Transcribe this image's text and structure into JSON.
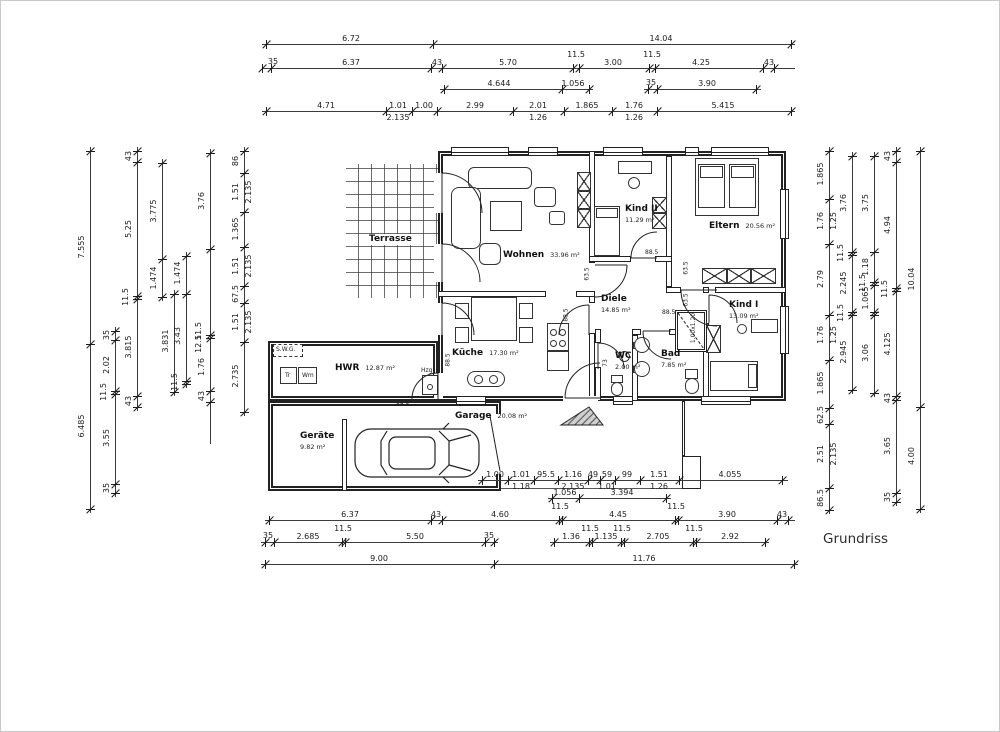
{
  "title": {
    "text": "Grundriss"
  },
  "colors": {
    "line": "#2a2a2a",
    "dim_text": "#1b1b1b",
    "bg": "#ffffff",
    "hatch": "#4a4a4a"
  },
  "rooms": [
    {
      "id": "terrasse",
      "name": "Terrasse",
      "area": ""
    },
    {
      "id": "wohnen",
      "name": "Wohnen",
      "area": "33.96 m²"
    },
    {
      "id": "kind2",
      "name": "Kind II",
      "area": "11.29 m²"
    },
    {
      "id": "eltern",
      "name": "Eltern",
      "area": "20.56 m²"
    },
    {
      "id": "diele",
      "name": "Diele",
      "area": "14.85 m²"
    },
    {
      "id": "kueche",
      "name": "Küche",
      "area": "17.30 m²"
    },
    {
      "id": "wc",
      "name": "WC",
      "area": "2.00 m²"
    },
    {
      "id": "bad",
      "name": "Bad",
      "area": "7.85 m²"
    },
    {
      "id": "kind1",
      "name": "Kind I",
      "area": "13.09 m²"
    },
    {
      "id": "hwr",
      "name": "HWR",
      "area": "12.87 m²"
    },
    {
      "id": "garage",
      "name": "Garage",
      "area": "20.08 m²"
    },
    {
      "id": "geraete",
      "name": "Geräte",
      "area": "9.82 m²"
    }
  ],
  "fixtures": {
    "swg": "S.W.G.",
    "tr": "Tr",
    "wm": "Wm",
    "hzg": "Hzg",
    "shower_size": "1.00x1.20"
  },
  "door_dimensions": [
    {
      "t": "88.5",
      "x": 644,
      "y": 249,
      "v": 0
    },
    {
      "t": "63.5",
      "x": 580,
      "y": 270,
      "v": 1
    },
    {
      "t": "63.5",
      "x": 679,
      "y": 264,
      "v": 1
    },
    {
      "t": "63.5",
      "x": 679,
      "y": 296,
      "v": 1
    },
    {
      "t": "73",
      "x": 601,
      "y": 359,
      "v": 1
    },
    {
      "t": "88.5",
      "x": 661,
      "y": 309,
      "v": 0
    },
    {
      "t": "88.5",
      "x": 395,
      "y": 401,
      "v": 0
    },
    {
      "t": "88.5",
      "x": 441,
      "y": 356,
      "v": 1
    },
    {
      "t": "88.5",
      "x": 559,
      "y": 311,
      "v": 1
    }
  ],
  "dim_chains": [
    {
      "o": "h",
      "p": 43,
      "a": 261,
      "b": 794,
      "ticks": [
        265,
        432,
        790
      ],
      "labels": [
        {
          "t": "6.72",
          "c": 350
        },
        {
          "t": "14.04",
          "c": 660
        }
      ]
    },
    {
      "o": "h",
      "p": 67,
      "a": 261,
      "b": 794,
      "ticks": [
        261,
        270,
        430,
        441,
        572,
        578,
        648,
        654,
        762,
        773
      ],
      "labels": [
        {
          "t": "35",
          "c": 272,
          "dy": -1
        },
        {
          "t": "6.37",
          "c": 350
        },
        {
          "t": "43",
          "c": 436
        },
        {
          "t": "5.70",
          "c": 507
        },
        {
          "t": "11.5",
          "c": 575,
          "dy": -8
        },
        {
          "t": "3.00",
          "c": 612
        },
        {
          "t": "11.5",
          "c": 651,
          "dy": -8
        },
        {
          "t": "4.25",
          "c": 700
        },
        {
          "t": "43",
          "c": 768
        }
      ]
    },
    {
      "o": "h",
      "p": 88,
      "a": 439,
      "b": 592,
      "ticks": [
        443,
        561,
        588
      ],
      "labels": [
        {
          "t": "4.644",
          "c": 498
        },
        {
          "t": "1.056",
          "c": 572
        }
      ]
    },
    {
      "o": "h",
      "p": 88,
      "a": 643,
      "b": 760,
      "ticks": [
        647,
        656,
        755
      ],
      "labels": [
        {
          "t": "35",
          "c": 650,
          "dy": -1
        },
        {
          "t": "3.90",
          "c": 706
        }
      ]
    },
    {
      "o": "h",
      "p": 110,
      "a": 261,
      "b": 794,
      "ticks": [
        265,
        385,
        411,
        436,
        512,
        563,
        611,
        656,
        790
      ],
      "labels": [
        {
          "t": "4.71",
          "c": 325
        },
        {
          "t": "1.01",
          "c": 397,
          "t2": "2.135"
        },
        {
          "t": "1.00",
          "c": 423
        },
        {
          "t": "2.99",
          "c": 474
        },
        {
          "t": "2.01",
          "c": 537,
          "t2": "1.26"
        },
        {
          "t": "1.865",
          "c": 586
        },
        {
          "t": "1.76",
          "c": 633,
          "t2": "1.26"
        },
        {
          "t": "5.415",
          "c": 722
        }
      ]
    },
    {
      "o": "h",
      "p": 479,
      "a": 477,
      "b": 787,
      "ticks": [
        481,
        507,
        533,
        557,
        587,
        599,
        614,
        639,
        678,
        781
      ],
      "labels": [
        {
          "t": "1.00",
          "c": 494
        },
        {
          "t": "1.01",
          "c": 520,
          "t2": "1.18"
        },
        {
          "t": "95.5",
          "c": 545
        },
        {
          "t": "1.16",
          "c": 572,
          "t2": "2.135"
        },
        {
          "t": "49",
          "c": 592
        },
        {
          "t": "59",
          "c": 606,
          "t2": "1.01"
        },
        {
          "t": "99",
          "c": 626
        },
        {
          "t": "1.51",
          "c": 658,
          "t2": "1.26"
        },
        {
          "t": "4.055",
          "c": 729
        }
      ]
    },
    {
      "o": "h",
      "p": 497,
      "a": 547,
      "b": 670,
      "ticks": [
        551,
        578,
        665
      ],
      "labels": [
        {
          "t": "1.056",
          "c": 564
        },
        {
          "t": "3.394",
          "c": 621
        }
      ]
    },
    {
      "o": "h",
      "p": 519,
      "a": 264,
      "b": 794,
      "ticks": [
        268,
        430,
        441,
        558,
        561,
        674,
        677,
        776,
        787
      ],
      "labels": [
        {
          "t": "6.37",
          "c": 349
        },
        {
          "t": "43",
          "c": 435
        },
        {
          "t": "4.60",
          "c": 499
        },
        {
          "t": "11.5",
          "c": 559,
          "dy": -8
        },
        {
          "t": "4.45",
          "c": 617
        },
        {
          "t": "11.5",
          "c": 675,
          "dy": -8
        },
        {
          "t": "3.90",
          "c": 726
        },
        {
          "t": "43",
          "c": 781
        }
      ]
    },
    {
      "o": "h",
      "p": 541,
      "a": 260,
      "b": 497,
      "ticks": [
        264,
        273,
        341,
        344,
        484,
        493
      ],
      "labels": [
        {
          "t": "35",
          "c": 267,
          "dy": -1
        },
        {
          "t": "2.685",
          "c": 307
        },
        {
          "t": "11.5",
          "c": 342,
          "dy": -8
        },
        {
          "t": "5.50",
          "c": 414
        },
        {
          "t": "35",
          "c": 488,
          "dy": -1
        }
      ]
    },
    {
      "o": "h",
      "p": 541,
      "a": 549,
      "b": 768,
      "ticks": [
        553,
        588,
        591,
        620,
        623,
        692,
        695,
        764
      ],
      "labels": [
        {
          "t": "1.36",
          "c": 570
        },
        {
          "t": "11.5",
          "c": 589,
          "dy": -8
        },
        {
          "t": "1.135",
          "c": 605
        },
        {
          "t": "11.5",
          "c": 621,
          "dy": -8
        },
        {
          "t": "2.705",
          "c": 657
        },
        {
          "t": "11.5",
          "c": 693,
          "dy": -8
        },
        {
          "t": "2.92",
          "c": 729
        }
      ]
    },
    {
      "o": "h",
      "p": 563,
      "a": 260,
      "b": 797,
      "ticks": [
        264,
        493,
        793
      ],
      "labels": [
        {
          "t": "9.00",
          "c": 378
        },
        {
          "t": "11.76",
          "c": 643
        }
      ]
    },
    {
      "o": "v",
      "p": 89,
      "a": 146,
      "b": 512,
      "ticks": [
        150,
        343,
        508
      ],
      "labels": [
        {
          "t": "7.555",
          "c": 246
        },
        {
          "t": "6.485",
          "c": 425
        }
      ]
    },
    {
      "o": "v",
      "p": 114,
      "a": 326,
      "b": 496,
      "ticks": [
        330,
        339,
        390,
        393,
        483,
        492
      ],
      "labels": [
        {
          "t": "35",
          "c": 334
        },
        {
          "t": "2.02",
          "c": 364
        },
        {
          "t": "11.5",
          "c": 391,
          "dx": -3
        },
        {
          "t": "3.55",
          "c": 437
        },
        {
          "t": "35",
          "c": 487
        }
      ]
    },
    {
      "o": "v",
      "p": 136,
      "a": 146,
      "b": 410,
      "ticks": [
        150,
        161,
        295,
        298,
        395,
        406
      ],
      "labels": [
        {
          "t": "43",
          "c": 155
        },
        {
          "t": "5.25",
          "c": 228
        },
        {
          "t": "11.5",
          "c": 296,
          "dx": -3
        },
        {
          "t": "3.815",
          "c": 346
        },
        {
          "t": "43",
          "c": 400
        }
      ]
    },
    {
      "o": "v",
      "p": 161,
      "a": 158,
      "b": 300,
      "ticks": [
        162,
        258,
        296
      ],
      "labels": [
        {
          "t": "3.775",
          "c": 210
        },
        {
          "t": "1.474",
          "c": 277
        }
      ]
    },
    {
      "o": "v",
      "p": 173,
      "a": 289,
      "b": 395,
      "ticks": [
        293,
        391
      ],
      "labels": [
        {
          "t": "3.831",
          "c": 340
        }
      ]
    },
    {
      "o": "v",
      "p": 185,
      "a": 251,
      "b": 387,
      "ticks": [
        255,
        293,
        380,
        383
      ],
      "labels": [
        {
          "t": "1.474",
          "c": 272
        },
        {
          "t": "3.43",
          "c": 335
        },
        {
          "t": "11.5",
          "c": 381,
          "dx": -3
        }
      ]
    },
    {
      "o": "v",
      "p": 209,
      "a": 148,
      "b": 443,
      "ticks": [
        152,
        248,
        334,
        337,
        390,
        401
      ],
      "labels": [
        {
          "t": "3.76",
          "c": 200
        },
        {
          "t": "11.5",
          "c": 330,
          "dx": -3
        },
        {
          "t": "12.5",
          "c": 343,
          "dx": -3
        },
        {
          "t": "1.76",
          "c": 366
        },
        {
          "t": "43",
          "c": 395
        }
      ]
    },
    {
      "o": "v",
      "p": 243,
      "a": 146,
      "b": 415,
      "ticks": [
        150,
        172,
        211,
        246,
        285,
        302,
        341,
        411
      ],
      "labels": [
        {
          "t": "86",
          "c": 160
        },
        {
          "t": "1.51",
          "c": 191,
          "t2": "2.135"
        },
        {
          "t": "1.365",
          "c": 228
        },
        {
          "t": "1.51",
          "c": 265,
          "t2": "2.135"
        },
        {
          "t": "67.5",
          "c": 293
        },
        {
          "t": "1.51",
          "c": 321,
          "t2": "2.135"
        },
        {
          "t": "2.735",
          "c": 375
        }
      ]
    },
    {
      "o": "v",
      "p": 828,
      "a": 146,
      "b": 513,
      "ticks": [
        150,
        198,
        243,
        314,
        359,
        407,
        423,
        487,
        509
      ],
      "labels": [
        {
          "t": "1.865",
          "c": 173
        },
        {
          "t": "1.76",
          "c": 220,
          "t2": "1.25"
        },
        {
          "t": "2.79",
          "c": 278
        },
        {
          "t": "1.76",
          "c": 334,
          "t2": "1.25"
        },
        {
          "t": "1.865",
          "c": 382
        },
        {
          "t": "62.5",
          "c": 414
        },
        {
          "t": "2.51",
          "c": 453,
          "t2": "2.135"
        },
        {
          "t": "86.5",
          "c": 497
        }
      ]
    },
    {
      "o": "v",
      "p": 851,
      "a": 151,
      "b": 393,
      "ticks": [
        155,
        251,
        254,
        311,
        314,
        389
      ],
      "labels": [
        {
          "t": "3.76",
          "c": 202
        },
        {
          "t": "11.5",
          "c": 252,
          "dx": -3
        },
        {
          "t": "2.245",
          "c": 282
        },
        {
          "t": "11.5",
          "c": 312,
          "dx": -3
        },
        {
          "t": "2.945",
          "c": 351
        }
      ]
    },
    {
      "o": "v",
      "p": 873,
      "a": 151,
      "b": 396,
      "ticks": [
        155,
        251,
        281,
        284,
        311,
        314,
        392
      ],
      "labels": [
        {
          "t": "3.75",
          "c": 202
        },
        {
          "t": "1.18",
          "c": 266
        },
        {
          "t": "11.5",
          "c": 282,
          "dx": -3
        },
        {
          "t": "1.065",
          "c": 297
        },
        {
          "t": "3.06",
          "c": 352
        }
      ]
    },
    {
      "o": "v",
      "p": 895,
      "a": 146,
      "b": 505,
      "ticks": [
        150,
        161,
        287,
        290,
        395,
        399,
        492,
        501
      ],
      "labels": [
        {
          "t": "43",
          "c": 155
        },
        {
          "t": "4.94",
          "c": 224
        },
        {
          "t": "11.5",
          "c": 288,
          "dx": -3
        },
        {
          "t": "4.125",
          "c": 343
        },
        {
          "t": "43",
          "c": 397
        },
        {
          "t": "3.65",
          "c": 445
        },
        {
          "t": "35",
          "c": 496
        }
      ]
    },
    {
      "o": "v",
      "p": 919,
      "a": 146,
      "b": 512,
      "ticks": [
        150,
        406,
        508
      ],
      "labels": [
        {
          "t": "10.04",
          "c": 278
        },
        {
          "t": "4.00",
          "c": 455
        }
      ]
    }
  ]
}
